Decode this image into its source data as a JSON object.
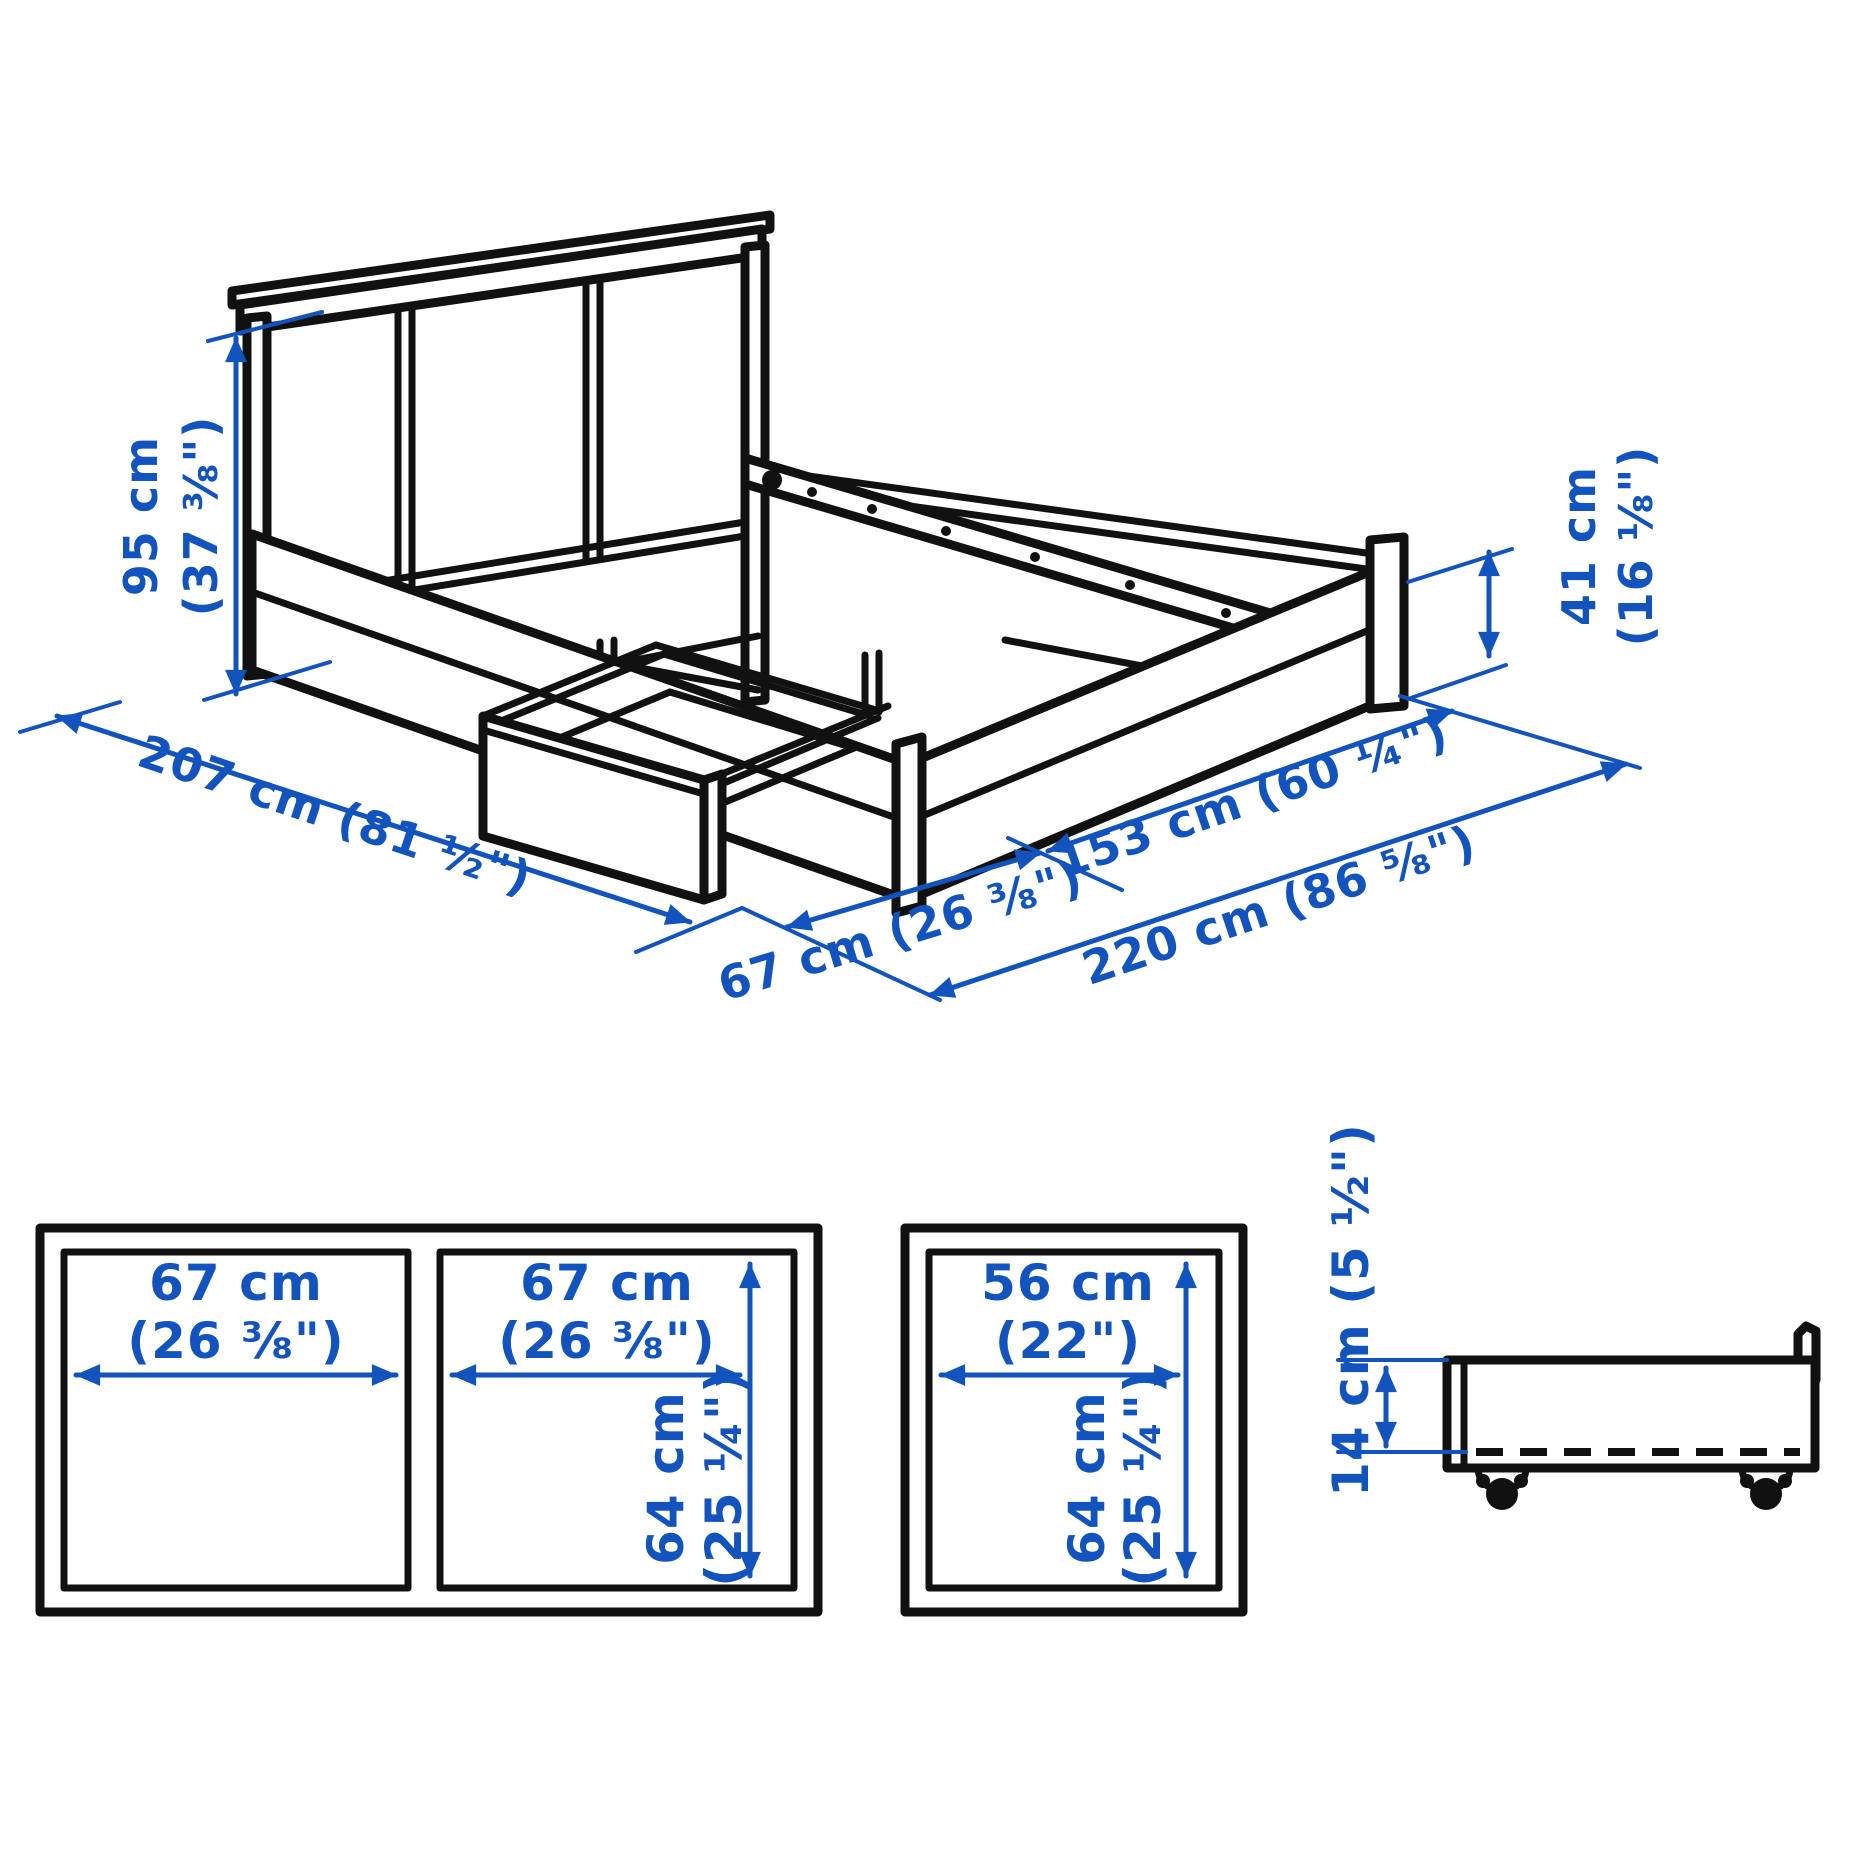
{
  "colors": {
    "background": "#ffffff",
    "line_black": "#111111",
    "dimension_blue": "#1253be"
  },
  "bed_view": {
    "description": "bed frame with storage, isometric line drawing",
    "dims": {
      "headboard_height": {
        "line1": "95 cm",
        "line2": "(37 ⅜\")"
      },
      "frame_height": {
        "line1": "41 cm",
        "line2": "(16 ⅛\")"
      },
      "length": "207 cm (81 ½\")",
      "drawer_extension": "67 cm (26 ⅜\")",
      "width": "153 cm (60 ¼\")",
      "total_length": "220 cm (86 ⅝\")"
    }
  },
  "storage_box_front_view": {
    "compartments": [
      {
        "line1": "67 cm",
        "line2": "(26 ⅜\")"
      },
      {
        "line1": "67 cm",
        "line2": "(26 ⅜\")"
      }
    ],
    "height": {
      "line1": "64 cm",
      "line2": "(25 ¼\")"
    }
  },
  "storage_box_end_view": {
    "width": {
      "line1": "56 cm",
      "line2": "(22\")"
    },
    "height": {
      "line1": "64 cm",
      "line2": "(25 ¼\")"
    }
  },
  "drawer_profile_view": {
    "height": "14 cm (5 ½\")"
  }
}
